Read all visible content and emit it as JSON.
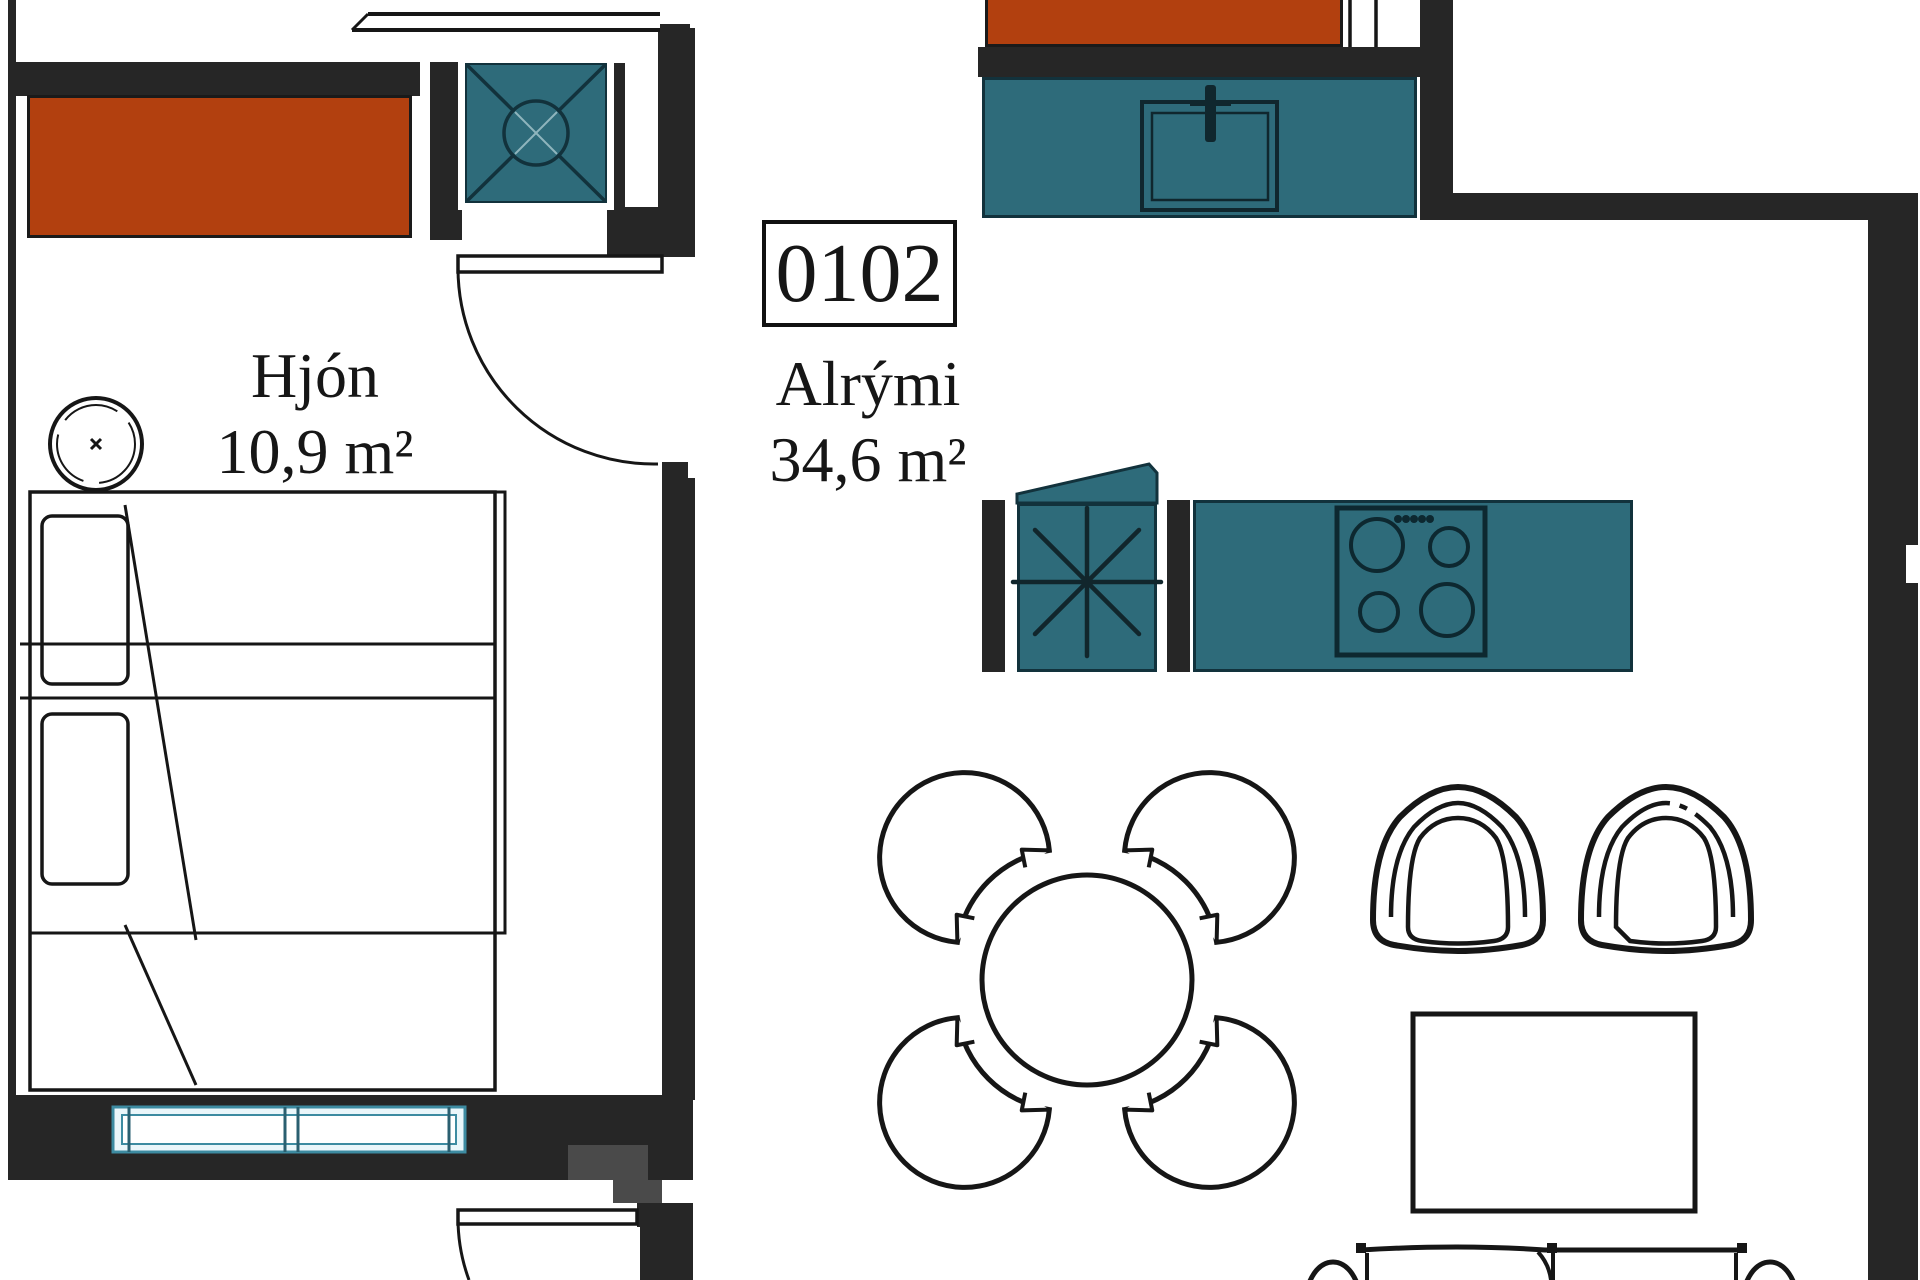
{
  "floorplan": {
    "apartment_number": "0102",
    "rooms": [
      {
        "name": "Hjón",
        "area": "10,9 m²"
      },
      {
        "name": "Alrými",
        "area": "34,6 m²"
      }
    ],
    "colors": {
      "wall": "#262626",
      "wall_secondary": "#4a4a4a",
      "fixture_red": "#b2400f",
      "fixture_teal": "#2e6b7a",
      "fixture_teal_border": "#12323c",
      "window_frame": "#3d8ba1",
      "line": "#161616",
      "background": "#ffffff"
    },
    "furniture": {
      "bedroom": [
        "double-bed",
        "pillows",
        "bedside-lamp-top",
        "bedside-lamp-bottom",
        "wardrobe-red",
        "ventilation-shaft",
        "window-bottom",
        "door-bedroom"
      ],
      "living": [
        "kitchen-counter-sink",
        "kitchen-counter-stove",
        "fridge",
        "dining-table-round",
        "dining-chairs-4",
        "armchair-left",
        "armchair-right",
        "coffee-table",
        "sofa",
        "entry-door"
      ]
    }
  }
}
